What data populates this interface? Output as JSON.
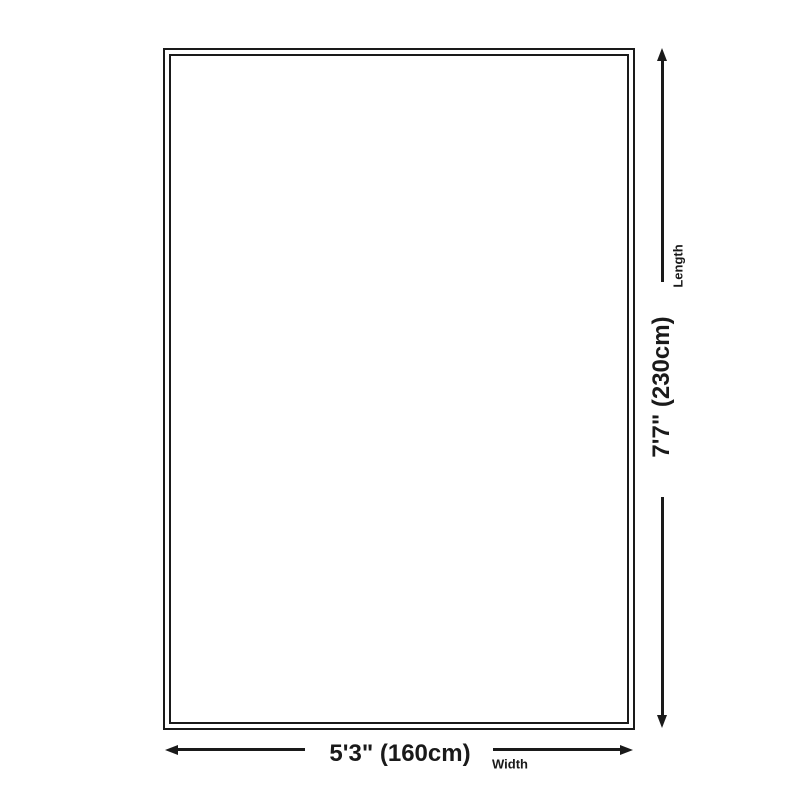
{
  "diagram": {
    "length": {
      "value": "7'7\" (230cm)",
      "label": "Length"
    },
    "width": {
      "value": "5'3\" (160cm)",
      "label": "Width"
    },
    "colors": {
      "ink": "#1a1a1a",
      "background": "#ffffff"
    }
  }
}
